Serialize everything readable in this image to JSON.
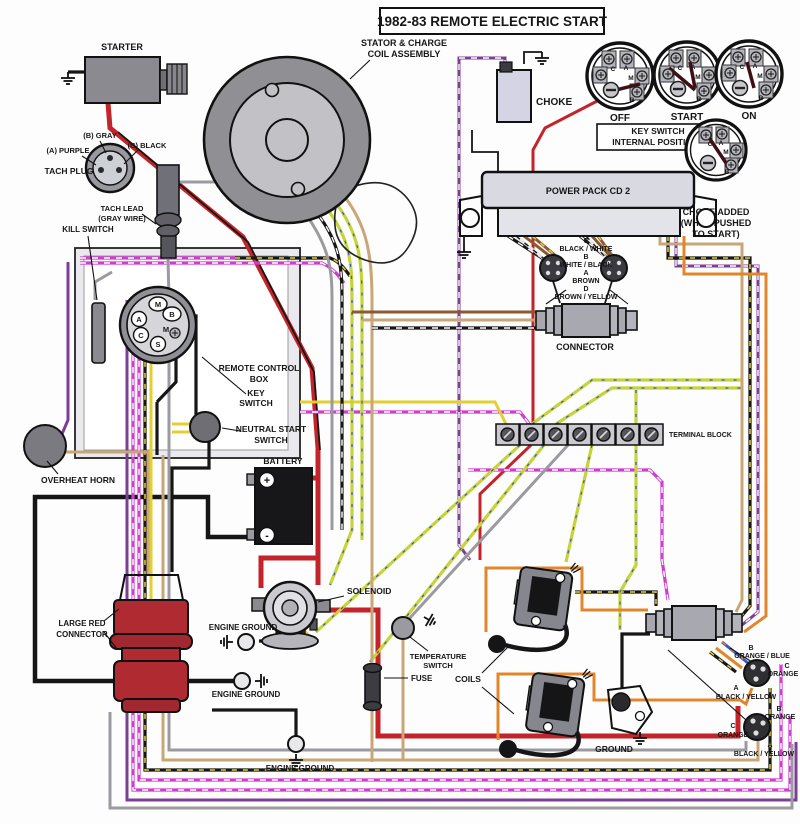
{
  "title": "1982-83 REMOTE ELECTRIC START",
  "colors": {
    "red_wire": "#c42429",
    "magenta_wire": "#cf3ccf",
    "purple_wire": "#7a3f95",
    "yellow_wire": "#e3cf2e",
    "yellow_green_wire": "#c5d438",
    "tan_wire": "#c9a678",
    "orange_wire": "#e2862c",
    "gray_component": "#9a9aa0",
    "red_connector_body": "#b02a32",
    "battery_body": "#17171a"
  },
  "labels": {
    "starter": "STARTER",
    "stator1": "STATOR & CHARGE",
    "stator2": "COIL ASSEMBLY",
    "choke": "CHOKE",
    "key_internal1": "KEY SWITCH",
    "key_internal2": "INTERNAL POSITIONS",
    "choke_added1": "CHOKE ADDED",
    "choke_added2": "(WHEN PUSHED",
    "choke_added3": "TO START)",
    "power_pack": "POWER PACK CD 2",
    "connector": "CONNECTOR",
    "terminal_block": "TERMINAL BLOCK",
    "tach_b": "(B) GRAY",
    "tach_a": "(A) PURPLE",
    "tach_c": "(C) BLACK",
    "tach_plug": "TACH PLUG",
    "tach_lead1": "TACH LEAD",
    "tach_lead2": "(GRAY WIRE)",
    "kill_switch": "KILL SWITCH",
    "remote1": "REMOTE CONTROL",
    "remote2": "BOX",
    "key1": "KEY",
    "key2": "SWITCH",
    "neutral1": "NEUTRAL START",
    "neutral2": "SWITCH",
    "horn": "OVERHEAT HORN",
    "battery": "BATTERY",
    "plus": "+",
    "minus": "-",
    "large_red1": "LARGE RED",
    "large_red2": "CONNECTOR",
    "solenoid": "SOLENOID",
    "engine_ground": "ENGINE GROUND",
    "temp1": "TEMPERATURE",
    "temp2": "SWITCH",
    "fuse": "FUSE",
    "coils": "COILS",
    "ground": "GROUND"
  },
  "key_switch_panel": {
    "positions": [
      "OFF",
      "START",
      "ON"
    ],
    "terminals": [
      "C",
      "A",
      "M",
      "B"
    ]
  },
  "remote_key_switch": {
    "terminals": [
      "M",
      "A",
      "B",
      "C",
      "M",
      "S"
    ]
  },
  "powerpack_plugs": [
    {
      "pin": "C",
      "color": "BLACK / WHITE"
    },
    {
      "pin": "B",
      "color": "WHITE / BLACK"
    },
    {
      "pin": "A",
      "color": "BROWN"
    },
    {
      "pin": "D",
      "color": "BROWN / YELLOW"
    }
  ],
  "engine_plug_top": [
    {
      "pin": "B",
      "color": "ORANGE / BLUE"
    },
    {
      "pin": "C",
      "color": "ORANGE"
    },
    {
      "pin": "A",
      "color": "BLACK / YELLOW"
    }
  ],
  "engine_plug_bottom": [
    {
      "pin": "B",
      "color": "ORANGE"
    },
    {
      "pin": "C",
      "color": "ORANGE"
    },
    {
      "pin": "A",
      "color": "BLACK / YELLOW"
    }
  ]
}
